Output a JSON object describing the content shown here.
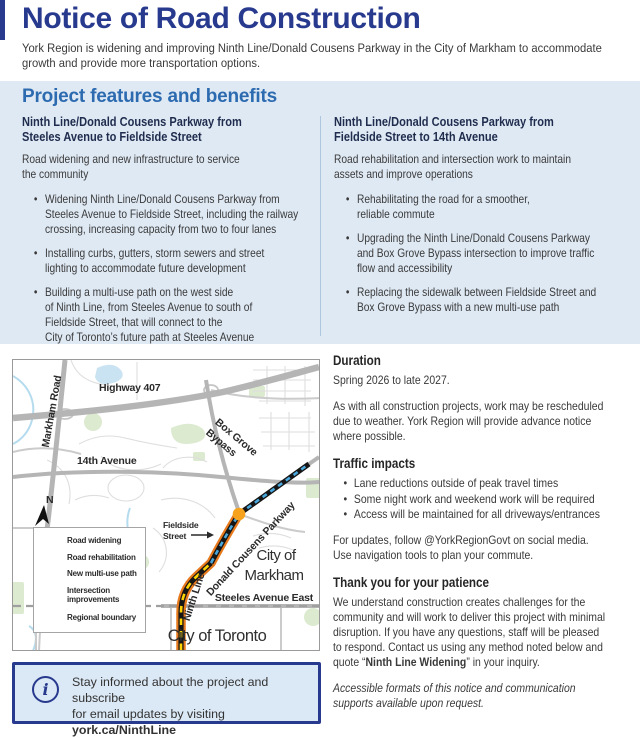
{
  "header": {
    "title": "Notice of Road Construction",
    "intro": "York Region is widening and improving Ninth Line/Donald Cousens Parkway in the City of Markham to accommodate\ngrowth and provide more transportation options."
  },
  "features": {
    "section_title": "Project features and benefits",
    "left": {
      "heading": "Ninth Line/Donald Cousens Parkway from\nSteeles Avenue to Fieldside Street",
      "subheading": "Road widening and new infrastructure to service\nthe community",
      "bullets": [
        "Widening Ninth Line/Donald Cousens Parkway from\nSteeles Avenue to Fieldside Street, including the railway\ncrossing, increasing capacity from two to four lanes",
        "Installing curbs, gutters, storm sewers and street\nlighting to accommodate future development",
        "Building a multi-use path on the west side\nof Ninth Line, from Steeles Avenue to south of\nFieldside Street, that will connect to the\nCity of Toronto’s future path at Steeles Avenue"
      ]
    },
    "right": {
      "heading": "Ninth Line/Donald Cousens Parkway from\nFieldside Street to 14th Avenue",
      "subheading": "Road rehabilitation and intersection work to maintain\nassets and improve operations",
      "bullets": [
        "Rehabilitating the road for a smoother,\nreliable commute",
        "Upgrading the Ninth Line/Donald Cousens Parkway\nand Box Grove Bypass intersection to improve traffic\nflow and accessibility",
        "Replacing the sidewalk between Fieldside Street and\nBox Grove Bypass with a new multi-use path"
      ]
    }
  },
  "map": {
    "labels": {
      "highway_407": "Highway 407",
      "markham_road": "Markham Road",
      "fourteenth_avenue": "14th Avenue",
      "box_grove_line1": "Box Grove",
      "box_grove_line2": "Bypass",
      "fieldside_line1": "Fieldside",
      "fieldside_line2": "Street",
      "donald_cousens_parkway": "Donald Cousens Parkway",
      "ninth_line": "Ninth Line",
      "city_of_markham_line1": "City of",
      "city_of_markham_line2": "Markham",
      "steeles_avenue_east": "Steeles Avenue East",
      "city_of_toronto": "City of Toronto",
      "north": "N"
    },
    "legend": {
      "items": [
        "Road widening",
        "Road rehabilitation",
        "New multi-use path",
        "Intersection improvements",
        "Regional boundary"
      ]
    },
    "colors": {
      "road_widening_dash": "#ffd400",
      "road_rehabilitation_dash": "#4aa8dc",
      "multi_use_path": "#e87a1e",
      "intersection_dot": "#f6a21d",
      "regional_boundary": "#a8a8a8"
    }
  },
  "details": {
    "duration_heading": "Duration",
    "duration_dates": "Spring 2026 to late 2027.",
    "duration_note": "As with all construction projects, work may be rescheduled\ndue to weather. York Region will provide advance notice\nwhere possible.",
    "traffic_heading": "Traffic impacts",
    "traffic_bullets": [
      "Lane reductions outside of peak travel times",
      "Some night work and weekend work will be required",
      "Access will be maintained for all driveways/entrances"
    ],
    "updates_note": "For updates, follow @YorkRegionGovt on social media.\nUse navigation tools to plan your commute.",
    "thanks_heading": "Thank you for your patience",
    "thanks_before": "We understand construction creates challenges for the\ncommunity and will work to deliver this project with minimal\ndisruption. If you have any questions, staff will be pleased\nto respond. Contact us using any method noted below and\nquote “",
    "thanks_bold": "Ninth Line Widening",
    "thanks_after": "” in your inquiry.",
    "accessible_note": "Accessible formats of this notice and communication\nsupports available upon request."
  },
  "info_box": {
    "icon": "i",
    "line1": "Stay informed about the project and subscribe",
    "line2_prefix": "for email updates by visiting ",
    "line2_link": "york.ca/NinthLine"
  },
  "brand_colors": {
    "navy": "#283a8e",
    "section_blue": "#2d6bb0",
    "band_background": "#dfe9f4"
  }
}
